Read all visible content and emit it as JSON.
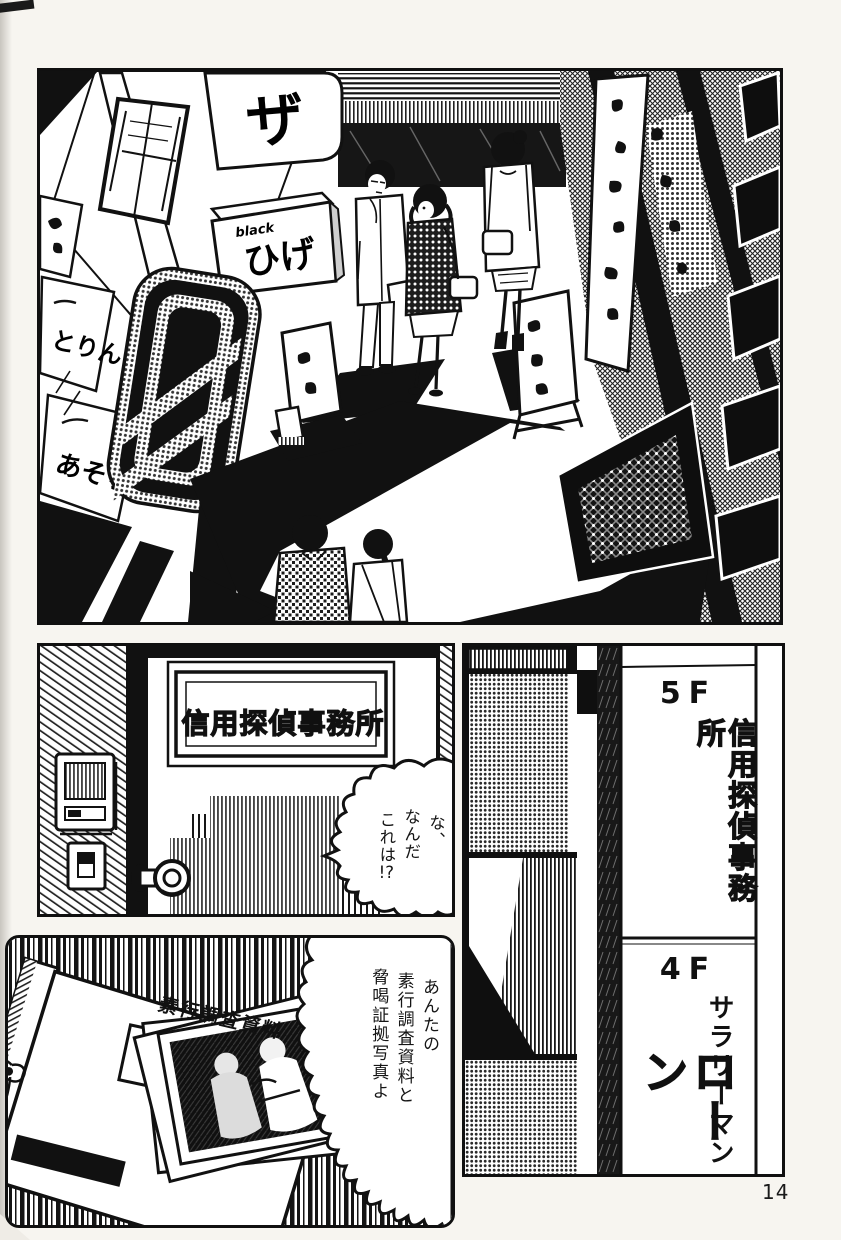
{
  "page": {
    "number": "14"
  },
  "street_panel": {
    "signs": {
      "za_sign": "ザ",
      "box_sign_small": "black",
      "box_sign_main": "ひげ",
      "pillar_sign_1": "とりん",
      "pillar_sign_2": "あそら"
    }
  },
  "office_door_panel": {
    "door_plate": "信用探偵事務所",
    "speech_bubble": {
      "lines": [
        "な、",
        "なんだ",
        "これは"
      ],
      "suffix": "!?"
    }
  },
  "directory_panel": {
    "floor_5": {
      "label": "5F",
      "tenant": "信用探偵事務所"
    },
    "floor_4": {
      "label": "4F",
      "tenant_top": "サラリーマン",
      "tenant_main": "ローン"
    }
  },
  "evidence_panel": {
    "folder_label": "素行調査資料",
    "speech_bubble": {
      "lines": [
        "あんたの",
        "素行調査資料と",
        "脅喝証拠写真よ"
      ]
    }
  }
}
